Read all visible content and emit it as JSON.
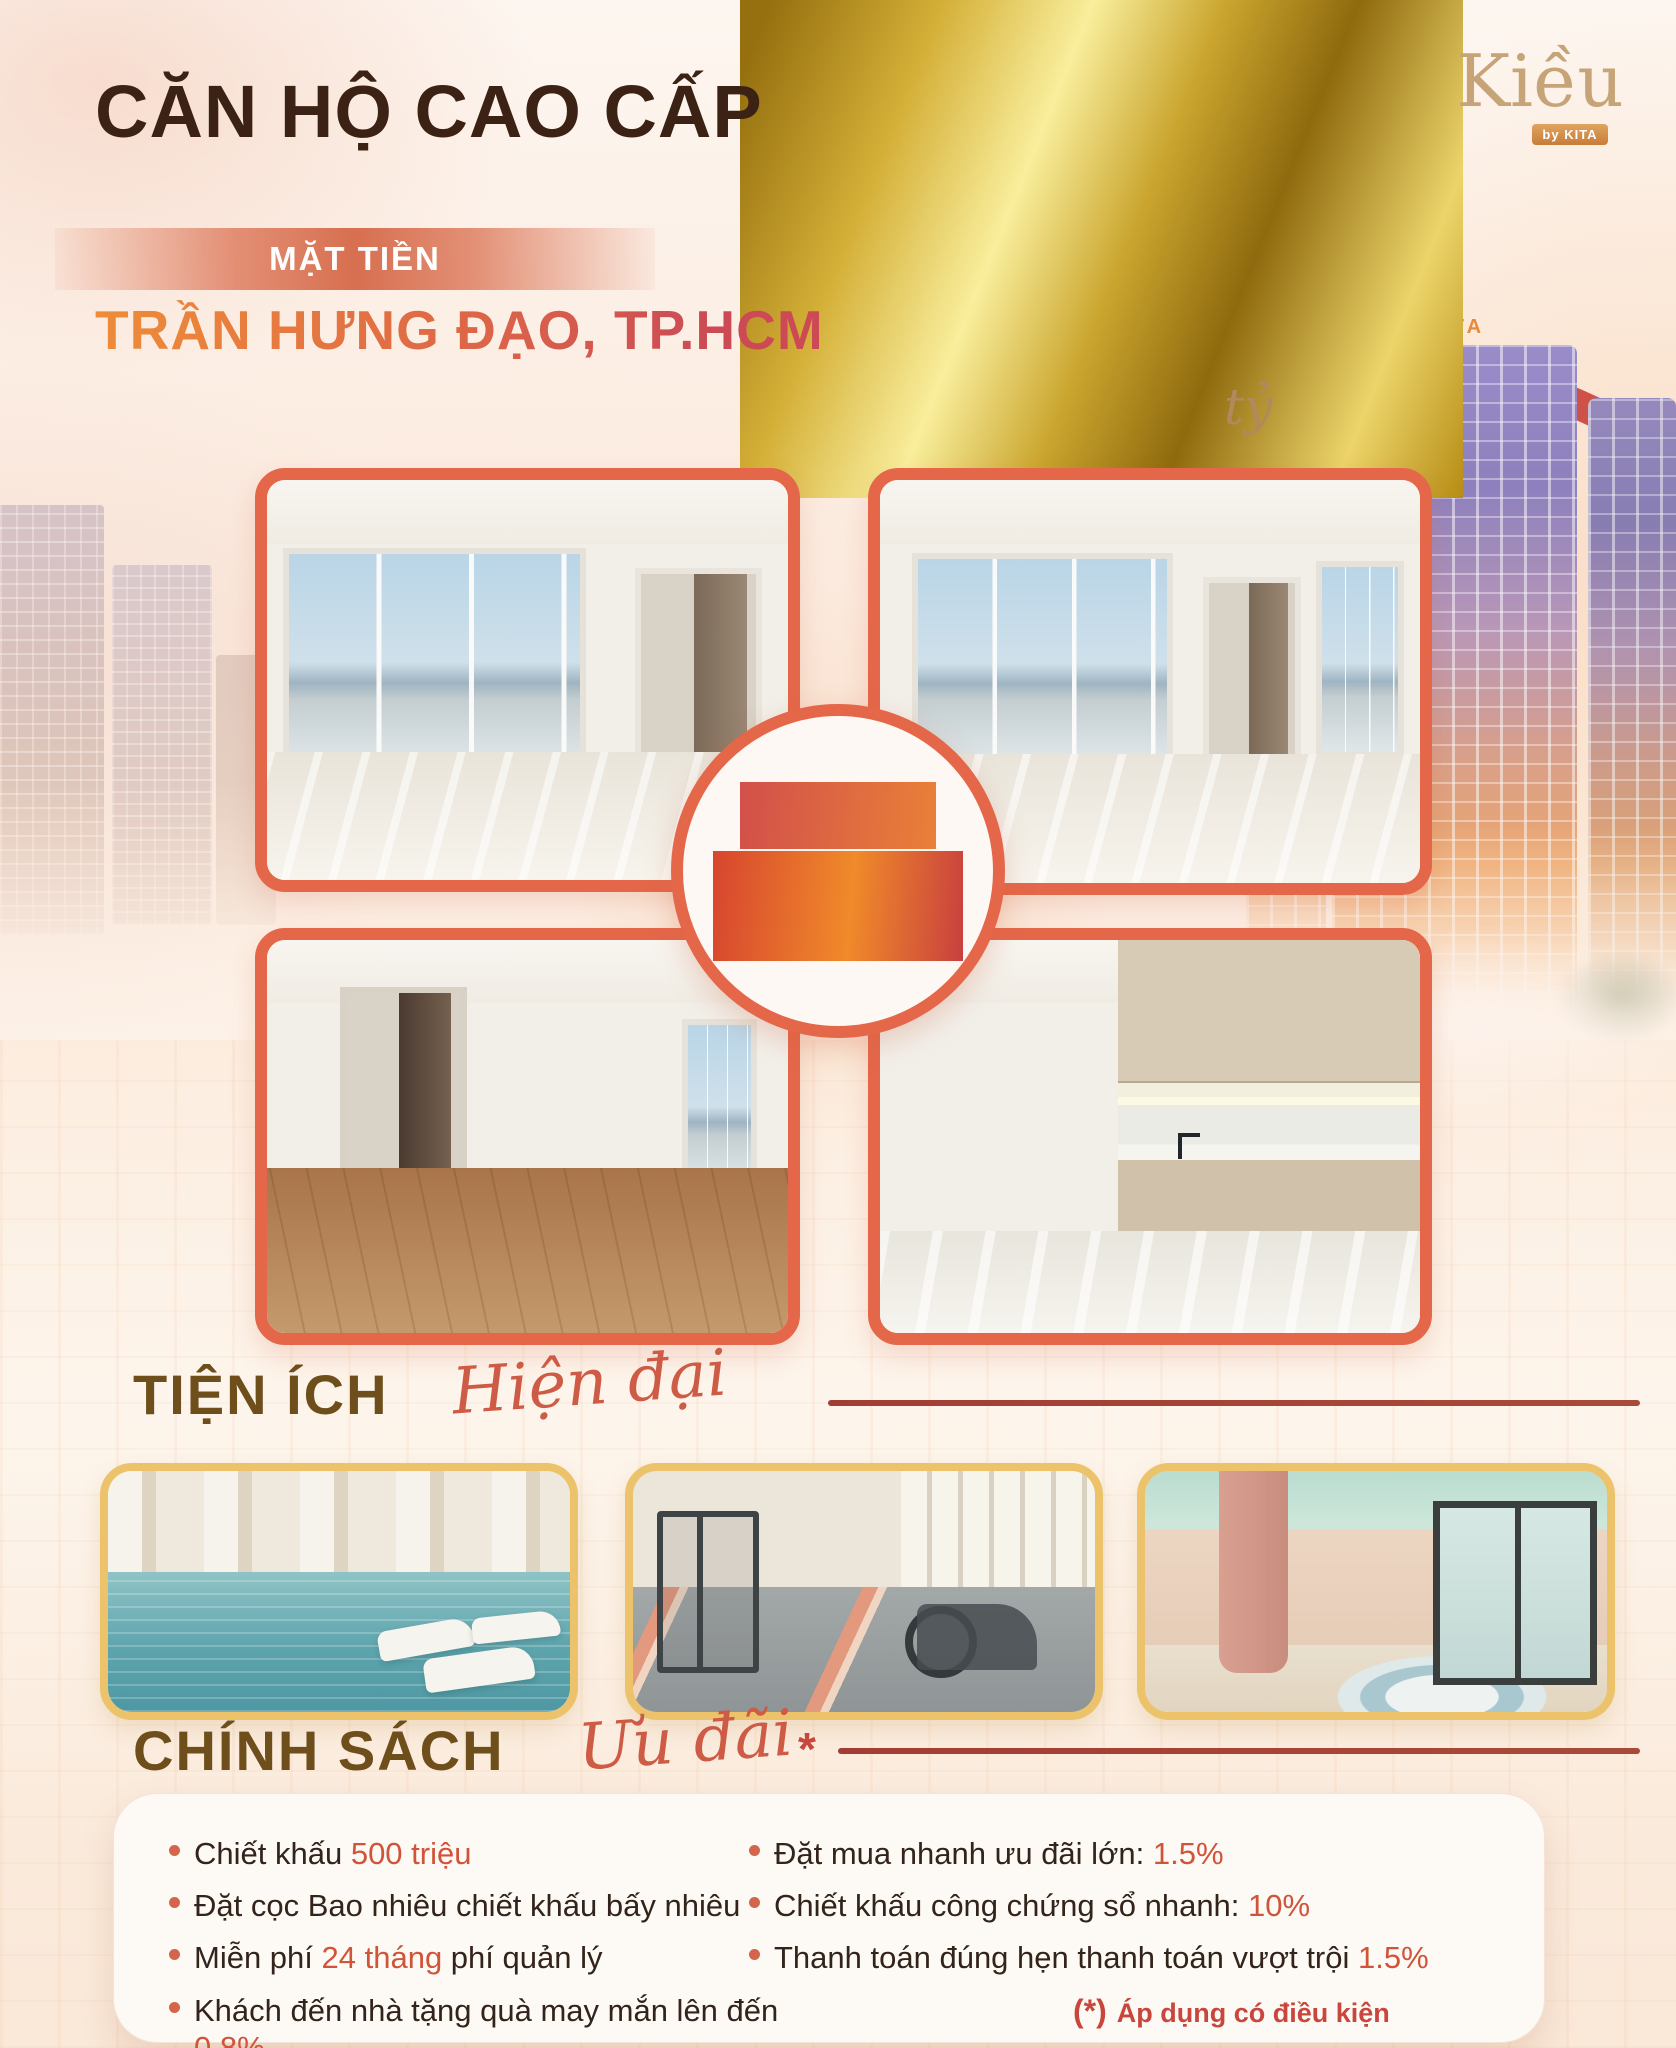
{
  "header": {
    "title": "CĂN HỘ CAO CẤP",
    "badge": "MẶT TIỀN",
    "subtitle": "TRẦN HƯNG ĐẠO, TP.HCM",
    "price_prefix": "chỉ từ",
    "price_number": "12",
    "price_unit": "tỷ"
  },
  "brand": {
    "name": "Kiều",
    "byline": "by KITA"
  },
  "building": {
    "sign": "KITA"
  },
  "center_badge": {
    "line1": "Căn hộ",
    "line2": "90m2"
  },
  "amenities": {
    "heading": "TIỆN ÍCH",
    "script": "Hiện đại"
  },
  "policy": {
    "heading": "CHÍNH SÁCH",
    "script": "Ưu đãi",
    "asterisk": "*",
    "left": [
      {
        "pre": "Chiết khấu ",
        "highlight": "500 triệu",
        "post": ""
      },
      {
        "pre": "Đặt cọc Bao nhiêu chiết khấu bấy nhiêu",
        "highlight": "",
        "post": ""
      },
      {
        "pre": "Miễn phí ",
        "highlight": "24 tháng",
        "post": " phí quản lý"
      },
      {
        "pre": "Khách đến nhà tặng quà may mắn lên đến ",
        "highlight": "0.8%",
        "post": ""
      }
    ],
    "right": [
      {
        "pre": "Đặt mua nhanh ưu đãi lớn: ",
        "highlight": "1.5%",
        "post": ""
      },
      {
        "pre": "Chiết khấu công chứng sổ nhanh: ",
        "highlight": "10%",
        "post": ""
      },
      {
        "pre": "Thanh toán đúng hẹn thanh toán vượt trội ",
        "highlight": "1.5%",
        "post": ""
      }
    ],
    "note_marker": "(*)",
    "note_text": "Áp dụng có điều kiện"
  },
  "colors": {
    "frame_coral": "#e5674a",
    "gold": "#d4af37",
    "title_brown": "#3b2214",
    "section_brown": "#6e4f1b",
    "accent_red": "#c8463c",
    "highlight": "#d0543a",
    "amenity_gold_border": "#ecc36b"
  }
}
